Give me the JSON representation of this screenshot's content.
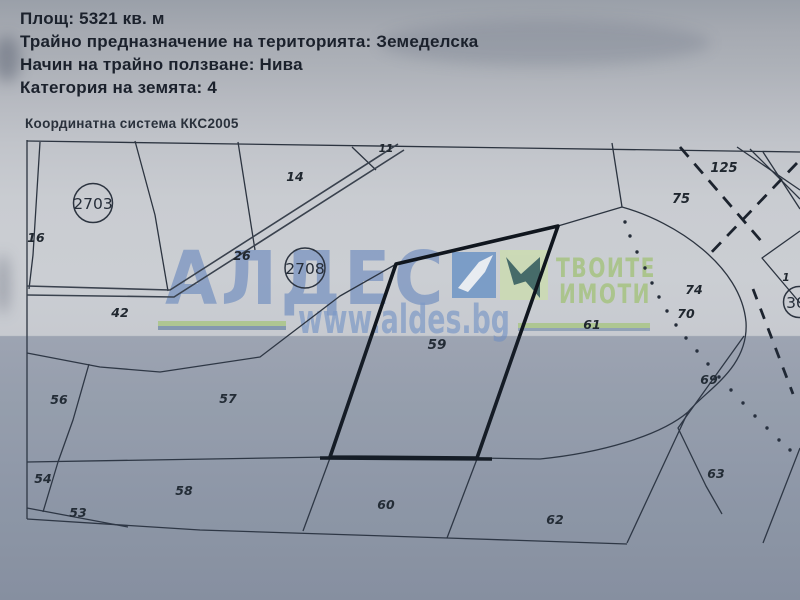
{
  "header": {
    "area_label": "Площ:",
    "area_value": "5321 кв. м",
    "designation_label": "Трайно предназначение на територията:",
    "designation_value": "Земеделска",
    "usage_label": "Начин на трайно ползване:",
    "usage_value": "Нива",
    "category_label": "Категория на земята:",
    "category_value": "4",
    "coordinate_system": "Координатна система ККС2005"
  },
  "watermark": {
    "brand": "АЛДЕС",
    "tagline_line1": "ТВОИТЕ",
    "tagline_line2": "ИМОТИ",
    "url": "www.aldes.bg"
  },
  "map": {
    "featured_parcel": "59",
    "circled": {
      "c2703": "2703",
      "c2708": "2708",
      "c30": "30"
    },
    "parcels": {
      "p11": "11",
      "p14": "14",
      "p16": "16",
      "p26": "26",
      "p42": "42",
      "p53": "53",
      "p54": "54",
      "p56": "56",
      "p57": "57",
      "p58": "58",
      "p59": "59",
      "p60": "60",
      "p61": "61",
      "p62": "62",
      "p63": "63",
      "p69": "69",
      "p70": "70",
      "p74": "74",
      "p75": "75",
      "p125": "125",
      "edge_fragment": "1"
    }
  },
  "colors": {
    "paper": "#c9ccd1",
    "line": "#2c3440",
    "featured_outline": "#10161e",
    "watermark_blue": "#7c96c2",
    "watermark_green": "#a7c385"
  }
}
